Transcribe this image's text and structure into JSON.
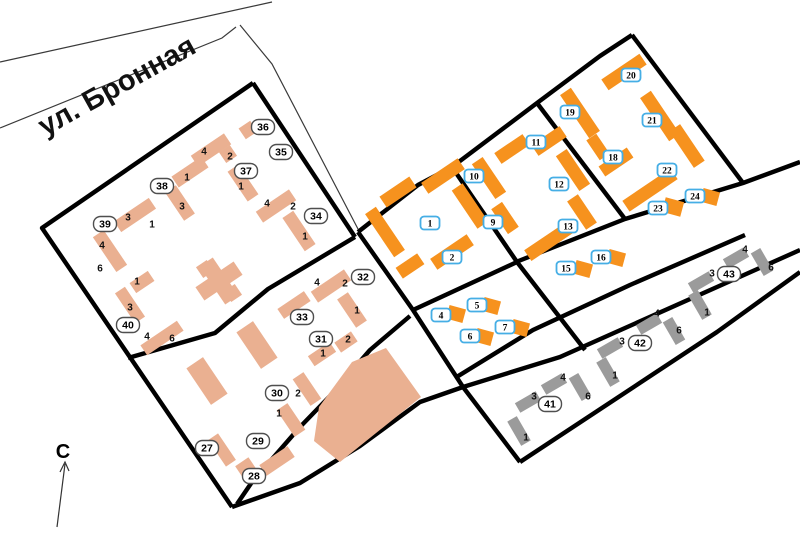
{
  "map": {
    "street_label": "ул. Бронная",
    "north_label": "С",
    "colors": {
      "tan": "#EAB091",
      "org": "#F6921E",
      "gry": "#9B9B9B",
      "road": "#000000",
      "blue_label_border": "#45AEE5",
      "oval_label_border": "#4F4F4F"
    },
    "roads_thin": [
      [
        [
          0,
          62
        ],
        [
          272,
          2
        ]
      ],
      [
        [
          0,
          128
        ],
        [
          222,
          38
        ],
        [
          236,
          27
        ]
      ],
      [
        [
          240,
          25
        ],
        [
          272,
          64
        ],
        [
          358,
          229
        ]
      ]
    ],
    "roads_thick": [
      [
        [
          253,
          83
        ],
        [
          42,
          228
        ],
        [
          232,
          507
        ]
      ],
      [
        [
          253,
          83
        ],
        [
          355,
          237
        ]
      ],
      [
        [
          128,
          358
        ],
        [
          215,
          333
        ],
        [
          268,
          289
        ],
        [
          355,
          237
        ]
      ],
      [
        [
          232,
          507
        ],
        [
          300,
          483
        ],
        [
          360,
          446
        ],
        [
          420,
          402
        ],
        [
          463,
          387
        ],
        [
          560,
          357
        ],
        [
          800,
          250
        ]
      ],
      [
        [
          358,
          232
        ],
        [
          413,
          310
        ],
        [
          463,
          387
        ],
        [
          520,
          462
        ]
      ],
      [
        [
          358,
          232
        ],
        [
          418,
          185
        ],
        [
          452,
          167
        ],
        [
          537,
          103
        ],
        [
          600,
          56
        ],
        [
          632,
          35
        ]
      ],
      [
        [
          632,
          35
        ],
        [
          743,
          183
        ]
      ],
      [
        [
          516,
          262
        ],
        [
          625,
          219
        ],
        [
          743,
          183
        ],
        [
          800,
          162
        ]
      ],
      [
        [
          537,
          103
        ],
        [
          625,
          219
        ]
      ],
      [
        [
          452,
          167
        ],
        [
          517,
          262
        ],
        [
          585,
          350
        ]
      ],
      [
        [
          413,
          310
        ],
        [
          517,
          262
        ]
      ],
      [
        [
          455,
          378
        ],
        [
          533,
          330
        ],
        [
          630,
          285
        ],
        [
          745,
          235
        ]
      ],
      [
        [
          520,
          462
        ],
        [
          717,
          332
        ],
        [
          800,
          272
        ]
      ],
      [
        [
          410,
          316
        ],
        [
          370,
          350
        ],
        [
          330,
          396
        ],
        [
          300,
          427
        ],
        [
          252,
          482
        ],
        [
          237,
          504
        ]
      ]
    ],
    "polygons": [
      {
        "k": "tan",
        "pts": [
          [
            386,
            348
          ],
          [
            421,
            397
          ],
          [
            340,
            462
          ],
          [
            314,
            441
          ],
          [
            319,
            407
          ],
          [
            352,
            362
          ]
        ]
      }
    ],
    "buildings": [
      {
        "k": "tan",
        "x": 248,
        "y": 130,
        "w": 14,
        "h": 13,
        "r": -34
      },
      {
        "k": "tan",
        "x": 228,
        "y": 154,
        "w": 13,
        "h": 13,
        "r": -34
      },
      {
        "k": "tan",
        "x": 211,
        "y": 150,
        "w": 40,
        "h": 13,
        "r": -34
      },
      {
        "k": "tan",
        "x": 243,
        "y": 183,
        "w": 13,
        "h": 36,
        "r": -34
      },
      {
        "k": "tan",
        "x": 190,
        "y": 172,
        "w": 36,
        "h": 13,
        "r": -34
      },
      {
        "k": "tan",
        "x": 180,
        "y": 203,
        "w": 13,
        "h": 34,
        "r": -34
      },
      {
        "k": "tan",
        "x": 135,
        "y": 215,
        "w": 42,
        "h": 13,
        "r": -34
      },
      {
        "k": "tan",
        "x": 110,
        "y": 251,
        "w": 13,
        "h": 42,
        "r": -34
      },
      {
        "k": "tan",
        "x": 276,
        "y": 206,
        "w": 40,
        "h": 13,
        "r": -34
      },
      {
        "k": "tan",
        "x": 299,
        "y": 231,
        "w": 13,
        "h": 40,
        "r": -34
      },
      {
        "k": "tan",
        "x": 142,
        "y": 282,
        "w": 22,
        "h": 12,
        "r": -34
      },
      {
        "k": "tan",
        "x": 130,
        "y": 305,
        "w": 12,
        "h": 36,
        "r": -34
      },
      {
        "k": "tan",
        "x": 162,
        "y": 338,
        "w": 44,
        "h": 12,
        "r": -34
      },
      {
        "k": "tan",
        "x": 219,
        "y": 281,
        "w": 46,
        "h": 16,
        "r": -34
      },
      {
        "k": "tan",
        "x": 219,
        "y": 281,
        "w": 16,
        "h": 46,
        "r": -34
      },
      {
        "k": "tan",
        "x": 233,
        "y": 293,
        "w": 13,
        "h": 13,
        "r": -34
      },
      {
        "k": "tan",
        "x": 205,
        "y": 269,
        "w": 13,
        "h": 13,
        "r": -34
      },
      {
        "k": "tan",
        "x": 294,
        "y": 305,
        "w": 32,
        "h": 12,
        "r": -34
      },
      {
        "k": "tan",
        "x": 331,
        "y": 286,
        "w": 40,
        "h": 13,
        "r": -34
      },
      {
        "k": "tan",
        "x": 352,
        "y": 310,
        "w": 13,
        "h": 34,
        "r": -34
      },
      {
        "k": "tan",
        "x": 322,
        "y": 354,
        "w": 26,
        "h": 12,
        "r": -34
      },
      {
        "k": "tan",
        "x": 346,
        "y": 342,
        "w": 20,
        "h": 12,
        "r": -34
      },
      {
        "k": "tan",
        "x": 307,
        "y": 389,
        "w": 13,
        "h": 32,
        "r": -34
      },
      {
        "k": "tan",
        "x": 291,
        "y": 420,
        "w": 13,
        "h": 32,
        "r": -34
      },
      {
        "k": "tan",
        "x": 277,
        "y": 461,
        "w": 34,
        "h": 13,
        "r": -34
      },
      {
        "k": "tan",
        "x": 246,
        "y": 468,
        "w": 16,
        "h": 15,
        "r": -34
      },
      {
        "k": "tan",
        "x": 222,
        "y": 450,
        "w": 12,
        "h": 32,
        "r": -34
      },
      {
        "k": "tan",
        "x": 207,
        "y": 381,
        "w": 20,
        "h": 44,
        "r": -34
      },
      {
        "k": "tan",
        "x": 257,
        "y": 345,
        "w": 20,
        "h": 44,
        "r": -34
      },
      {
        "k": "org",
        "x": 398,
        "y": 192,
        "w": 36,
        "h": 13,
        "r": -34
      },
      {
        "k": "org",
        "x": 443,
        "y": 176,
        "w": 44,
        "h": 13,
        "r": -34
      },
      {
        "k": "org",
        "x": 470,
        "y": 206,
        "w": 13,
        "h": 46,
        "r": -34
      },
      {
        "k": "org",
        "x": 452,
        "y": 252,
        "w": 44,
        "h": 13,
        "r": -34
      },
      {
        "k": "org",
        "x": 410,
        "y": 266,
        "w": 26,
        "h": 13,
        "r": -34
      },
      {
        "k": "org",
        "x": 385,
        "y": 232,
        "w": 13,
        "h": 52,
        "r": -34
      },
      {
        "k": "org",
        "x": 489,
        "y": 178,
        "w": 13,
        "h": 42,
        "r": -34
      },
      {
        "k": "org",
        "x": 512,
        "y": 149,
        "w": 34,
        "h": 13,
        "r": -34
      },
      {
        "k": "org",
        "x": 549,
        "y": 141,
        "w": 34,
        "h": 13,
        "r": -34
      },
      {
        "k": "org",
        "x": 573,
        "y": 170,
        "w": 13,
        "h": 42,
        "r": -34
      },
      {
        "k": "org",
        "x": 582,
        "y": 212,
        "w": 13,
        "h": 34,
        "r": -34
      },
      {
        "k": "org",
        "x": 551,
        "y": 240,
        "w": 56,
        "h": 13,
        "r": -34
      },
      {
        "k": "org",
        "x": 505,
        "y": 218,
        "w": 13,
        "h": 30,
        "r": -34
      },
      {
        "k": "org",
        "x": 580,
        "y": 113,
        "w": 13,
        "h": 52,
        "r": -34
      },
      {
        "k": "org",
        "x": 624,
        "y": 72,
        "w": 46,
        "h": 13,
        "r": -34
      },
      {
        "k": "org",
        "x": 660,
        "y": 116,
        "w": 13,
        "h": 52,
        "r": -34
      },
      {
        "k": "org",
        "x": 616,
        "y": 162,
        "w": 34,
        "h": 12,
        "r": -34
      },
      {
        "k": "org",
        "x": 598,
        "y": 147,
        "w": 12,
        "h": 24,
        "r": -34
      },
      {
        "k": "org",
        "x": 687,
        "y": 146,
        "w": 13,
        "h": 44,
        "r": -34
      },
      {
        "k": "org",
        "x": 650,
        "y": 190,
        "w": 58,
        "h": 13,
        "r": -34
      },
      {
        "k": "org",
        "x": 673,
        "y": 207,
        "w": 19,
        "h": 15,
        "r": 15
      },
      {
        "k": "org",
        "x": 710,
        "y": 197,
        "w": 17,
        "h": 14,
        "r": 15
      },
      {
        "k": "org",
        "x": 583,
        "y": 269,
        "w": 17,
        "h": 14,
        "r": 15
      },
      {
        "k": "org",
        "x": 616,
        "y": 258,
        "w": 17,
        "h": 14,
        "r": 15
      },
      {
        "k": "org",
        "x": 456,
        "y": 314,
        "w": 17,
        "h": 14,
        "r": 15
      },
      {
        "k": "org",
        "x": 491,
        "y": 306,
        "w": 17,
        "h": 14,
        "r": 15
      },
      {
        "k": "org",
        "x": 484,
        "y": 337,
        "w": 17,
        "h": 14,
        "r": 15
      },
      {
        "k": "org",
        "x": 520,
        "y": 328,
        "w": 17,
        "h": 14,
        "r": 15
      },
      {
        "k": "gry",
        "x": 528,
        "y": 402,
        "w": 24,
        "h": 11,
        "r": -30
      },
      {
        "k": "gry",
        "x": 554,
        "y": 384,
        "w": 24,
        "h": 11,
        "r": -30
      },
      {
        "k": "gry",
        "x": 580,
        "y": 387,
        "w": 11,
        "h": 26,
        "r": -30
      },
      {
        "k": "gry",
        "x": 519,
        "y": 431,
        "w": 11,
        "h": 28,
        "r": -30
      },
      {
        "k": "gry",
        "x": 610,
        "y": 348,
        "w": 24,
        "h": 11,
        "r": -30
      },
      {
        "k": "gry",
        "x": 649,
        "y": 324,
        "w": 24,
        "h": 11,
        "r": -30
      },
      {
        "k": "gry",
        "x": 674,
        "y": 331,
        "w": 11,
        "h": 26,
        "r": -30
      },
      {
        "k": "gry",
        "x": 608,
        "y": 372,
        "w": 11,
        "h": 28,
        "r": -30
      },
      {
        "k": "gry",
        "x": 701,
        "y": 282,
        "w": 24,
        "h": 11,
        "r": -30
      },
      {
        "k": "gry",
        "x": 736,
        "y": 258,
        "w": 24,
        "h": 11,
        "r": -30
      },
      {
        "k": "gry",
        "x": 762,
        "y": 262,
        "w": 11,
        "h": 26,
        "r": -30
      },
      {
        "k": "gry",
        "x": 700,
        "y": 305,
        "w": 11,
        "h": 28,
        "r": -30
      }
    ],
    "labels_blue": [
      {
        "t": "1",
        "x": 430,
        "y": 223
      },
      {
        "t": "2",
        "x": 452,
        "y": 257
      },
      {
        "t": "4",
        "x": 441,
        "y": 315
      },
      {
        "t": "5",
        "x": 477,
        "y": 305
      },
      {
        "t": "6",
        "x": 470,
        "y": 336
      },
      {
        "t": "7",
        "x": 505,
        "y": 327
      },
      {
        "t": "9",
        "x": 493,
        "y": 222
      },
      {
        "t": "10",
        "x": 474,
        "y": 176
      },
      {
        "t": "11",
        "x": 536,
        "y": 142
      },
      {
        "t": "12",
        "x": 559,
        "y": 184
      },
      {
        "t": "13",
        "x": 568,
        "y": 226
      },
      {
        "t": "15",
        "x": 566,
        "y": 268
      },
      {
        "t": "16",
        "x": 601,
        "y": 257
      },
      {
        "t": "18",
        "x": 613,
        "y": 157
      },
      {
        "t": "19",
        "x": 570,
        "y": 112
      },
      {
        "t": "20",
        "x": 631,
        "y": 75
      },
      {
        "t": "21",
        "x": 652,
        "y": 120
      },
      {
        "t": "22",
        "x": 667,
        "y": 170
      },
      {
        "t": "23",
        "x": 658,
        "y": 208
      },
      {
        "t": "24",
        "x": 695,
        "y": 196
      }
    ],
    "labels_oval": [
      {
        "t": "27",
        "x": 207,
        "y": 448
      },
      {
        "t": "28",
        "x": 254,
        "y": 476
      },
      {
        "t": "29",
        "x": 258,
        "y": 441
      },
      {
        "t": "30",
        "x": 277,
        "y": 393
      },
      {
        "t": "31",
        "x": 321,
        "y": 339
      },
      {
        "t": "32",
        "x": 363,
        "y": 277
      },
      {
        "t": "33",
        "x": 302,
        "y": 317
      },
      {
        "t": "34",
        "x": 316,
        "y": 216
      },
      {
        "t": "35",
        "x": 281,
        "y": 152
      },
      {
        "t": "36",
        "x": 263,
        "y": 127
      },
      {
        "t": "37",
        "x": 246,
        "y": 171
      },
      {
        "t": "38",
        "x": 162,
        "y": 186
      },
      {
        "t": "39",
        "x": 105,
        "y": 224
      },
      {
        "t": "40",
        "x": 128,
        "y": 325
      },
      {
        "t": "41",
        "x": 550,
        "y": 404
      },
      {
        "t": "42",
        "x": 640,
        "y": 343
      },
      {
        "t": "43",
        "x": 729,
        "y": 274
      }
    ],
    "corps_numbers": [
      {
        "t": "4",
        "x": 204,
        "y": 151
      },
      {
        "t": "2",
        "x": 230,
        "y": 156
      },
      {
        "t": "1",
        "x": 241,
        "y": 186
      },
      {
        "t": "1",
        "x": 187,
        "y": 177
      },
      {
        "t": "3",
        "x": 182,
        "y": 206
      },
      {
        "t": "3",
        "x": 128,
        "y": 217
      },
      {
        "t": "1",
        "x": 152,
        "y": 224
      },
      {
        "t": "4",
        "x": 102,
        "y": 245
      },
      {
        "t": "6",
        "x": 100,
        "y": 268
      },
      {
        "t": "1",
        "x": 137,
        "y": 281
      },
      {
        "t": "3",
        "x": 130,
        "y": 307
      },
      {
        "t": "4",
        "x": 147,
        "y": 336
      },
      {
        "t": "6",
        "x": 172,
        "y": 338
      },
      {
        "t": "4",
        "x": 267,
        "y": 203
      },
      {
        "t": "2",
        "x": 293,
        "y": 206
      },
      {
        "t": "1",
        "x": 305,
        "y": 236
      },
      {
        "t": "4",
        "x": 317,
        "y": 282
      },
      {
        "t": "2",
        "x": 345,
        "y": 283
      },
      {
        "t": "1",
        "x": 357,
        "y": 310
      },
      {
        "t": "2",
        "x": 348,
        "y": 339
      },
      {
        "t": "1",
        "x": 323,
        "y": 353
      },
      {
        "t": "2",
        "x": 298,
        "y": 393
      },
      {
        "t": "1",
        "x": 279,
        "y": 413
      },
      {
        "t": "3",
        "x": 534,
        "y": 396
      },
      {
        "t": "4",
        "x": 563,
        "y": 377
      },
      {
        "t": "6",
        "x": 588,
        "y": 396
      },
      {
        "t": "1",
        "x": 526,
        "y": 437
      },
      {
        "t": "3",
        "x": 622,
        "y": 341
      },
      {
        "t": "4",
        "x": 657,
        "y": 313
      },
      {
        "t": "6",
        "x": 679,
        "y": 330
      },
      {
        "t": "1",
        "x": 615,
        "y": 375
      },
      {
        "t": "3",
        "x": 712,
        "y": 273
      },
      {
        "t": "4",
        "x": 745,
        "y": 249
      },
      {
        "t": "6",
        "x": 771,
        "y": 267
      },
      {
        "t": "1",
        "x": 707,
        "y": 312
      }
    ]
  }
}
